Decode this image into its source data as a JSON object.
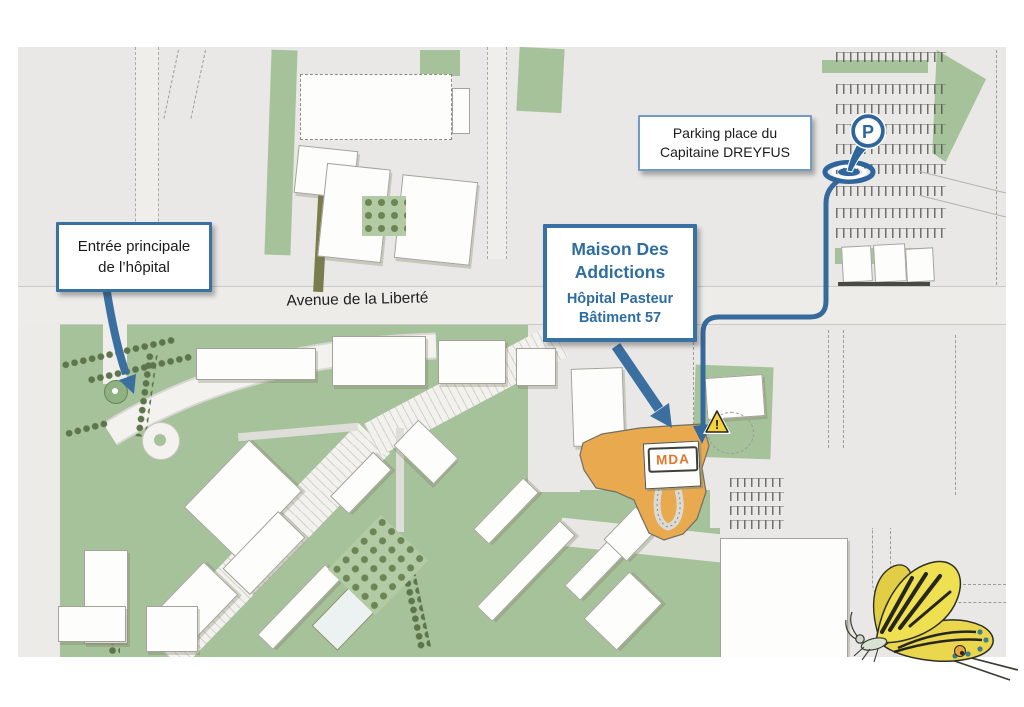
{
  "map": {
    "street_label": "Avenue de la Liberté",
    "callouts": {
      "entrance": "Entrée principale\nde l’hôpital",
      "parking": "Parking place du\nCapitaine DREYFUS",
      "mda_title": "Maison Des\nAddictions",
      "mda_subtitle": "Hôpital Pasteur\nBâtiment 57"
    },
    "markers": {
      "mda_building_tag": "MDA",
      "parking_pin_letter": "P",
      "warning_glyph": "!"
    },
    "colors": {
      "accent_blue": "#36699C",
      "callout_text_blue": "#2E6DA0",
      "mda_zone_orange": "#E9A94F",
      "mda_tag_orange": "#E0762B",
      "lawn_green": "#A6C29A",
      "tree_green": "#5E744B",
      "map_background": "#E9E8E6"
    }
  }
}
